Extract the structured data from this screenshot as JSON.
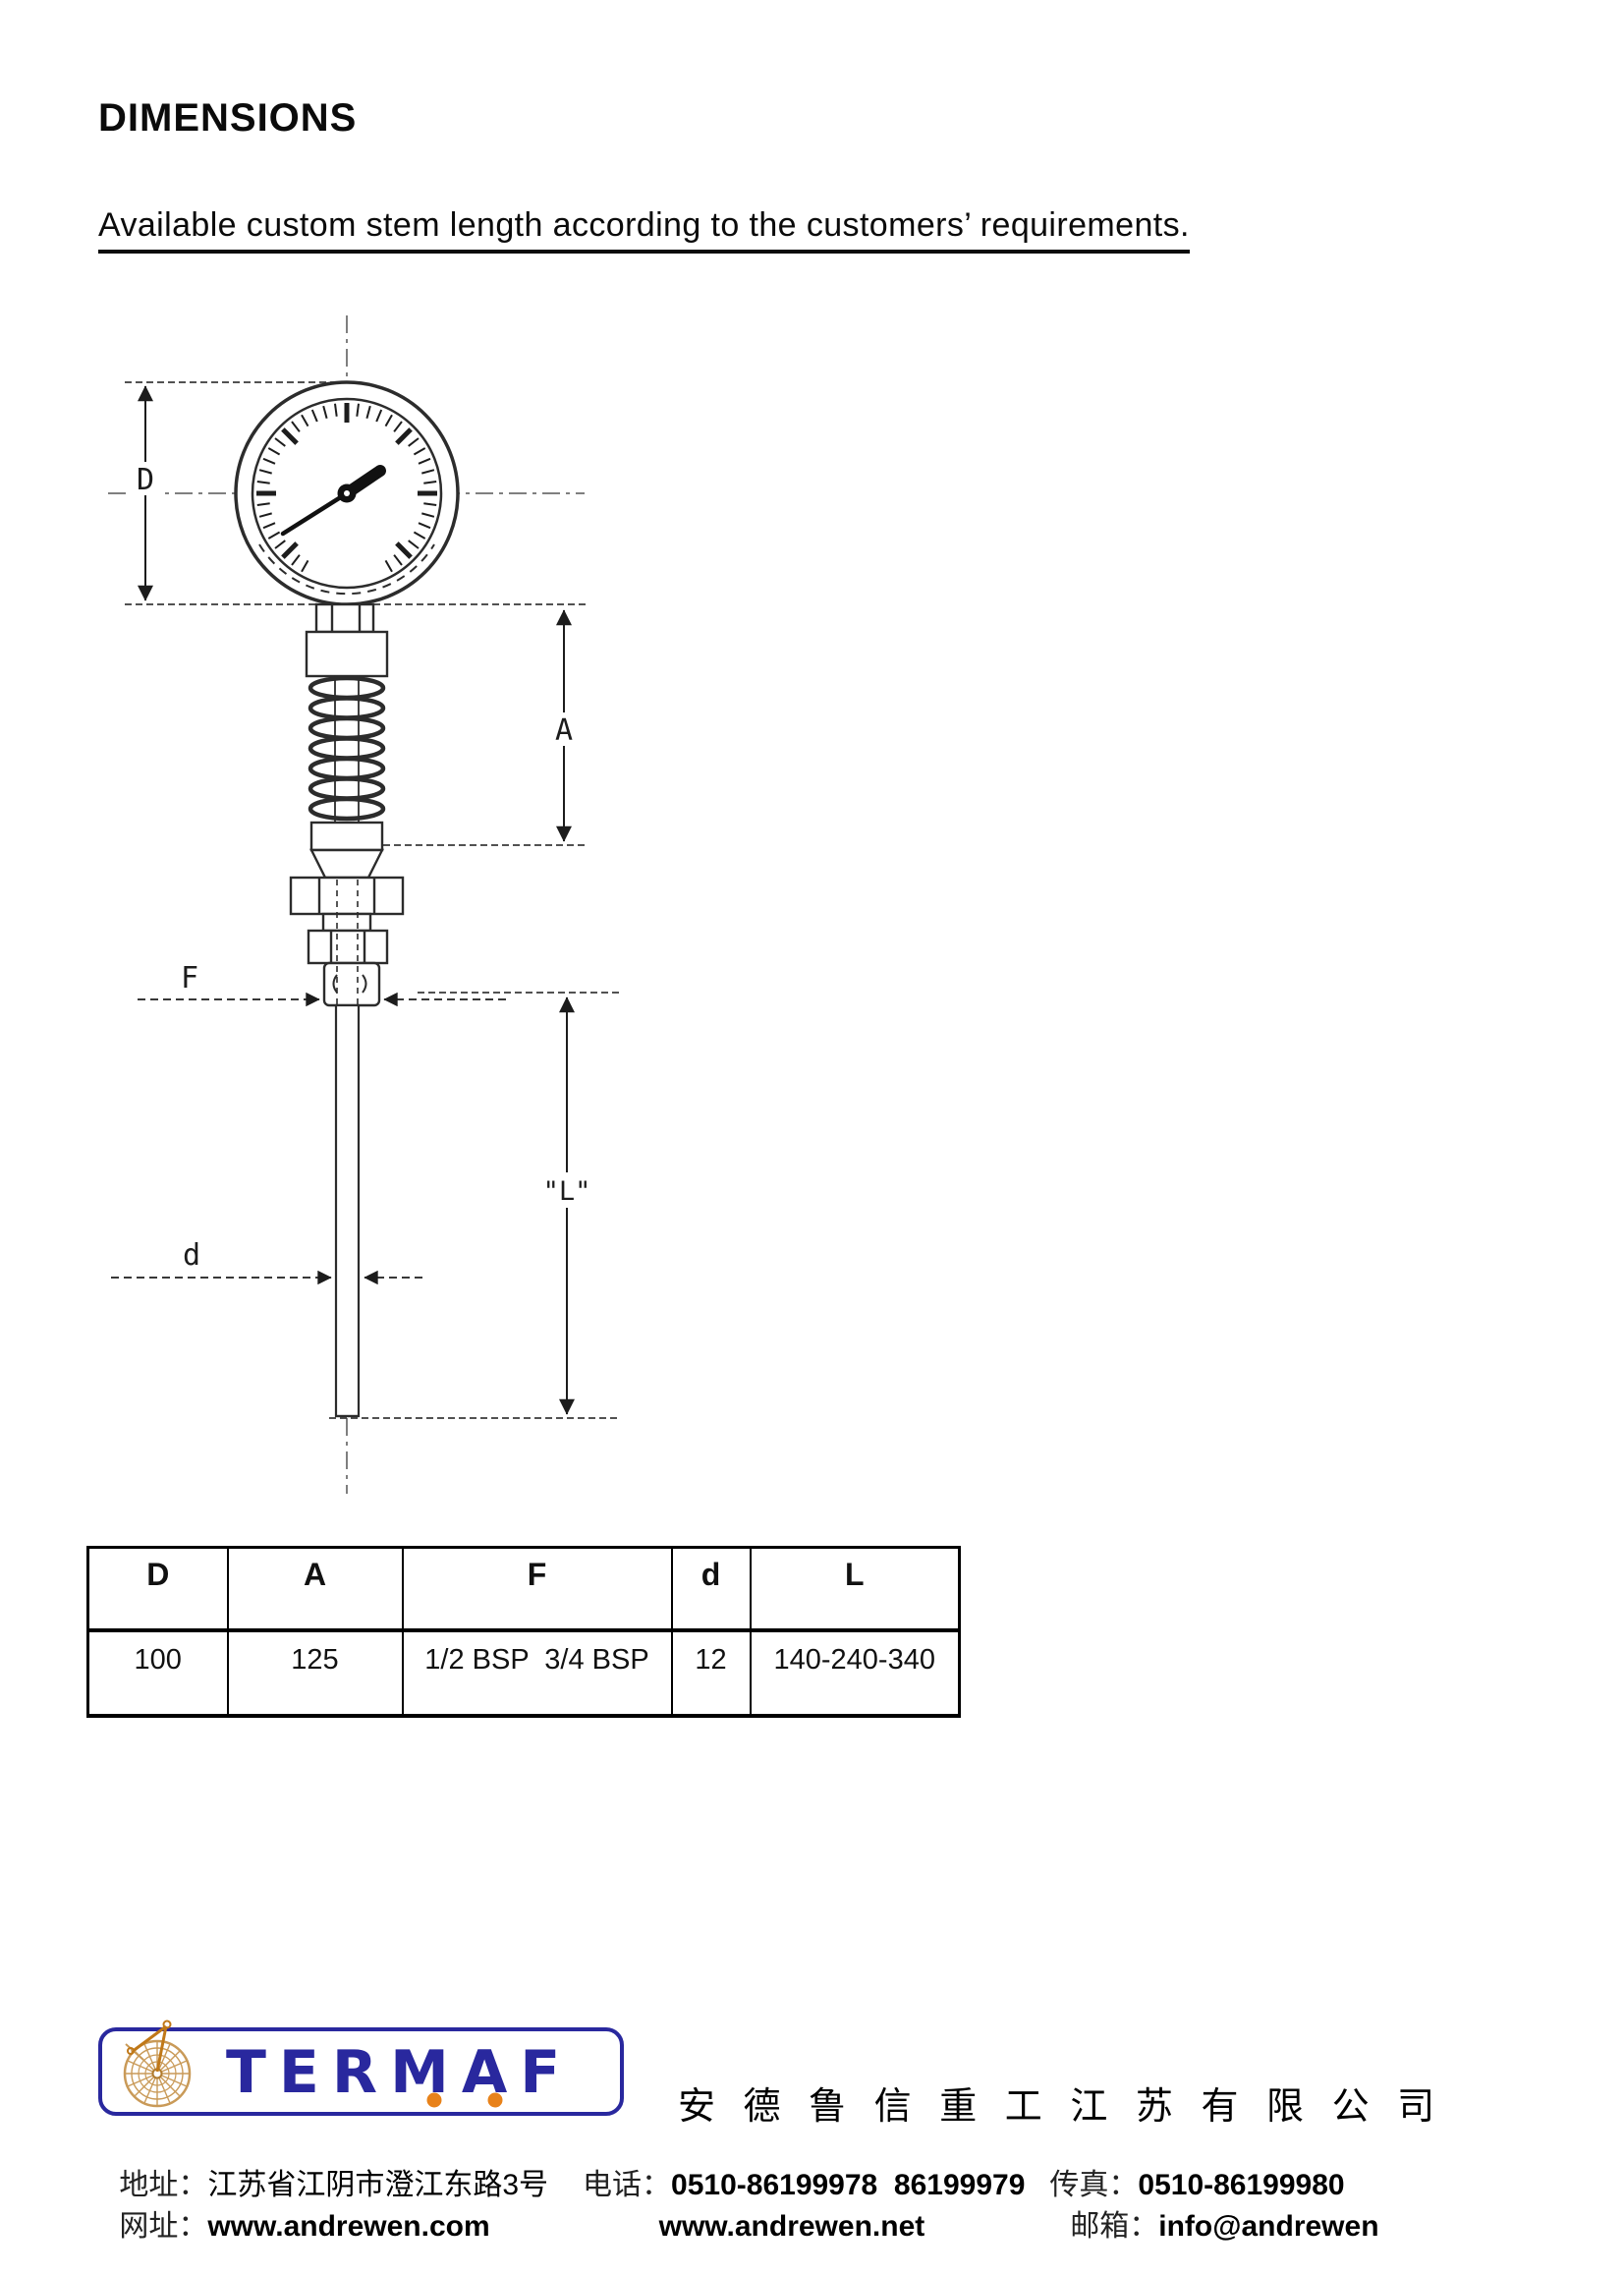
{
  "page": {
    "title": "DIMENSIONS",
    "subtitle": "Available custom stem length according to the customers’ requirements."
  },
  "drawing": {
    "labels": {
      "D": "D",
      "A": "A",
      "F": "F",
      "L": "\"L\"",
      "d": "d"
    }
  },
  "table": {
    "headers": [
      "D",
      "A",
      "F",
      "d",
      "L"
    ],
    "rows": [
      [
        "100",
        "125",
        "1/2 BSP  3/4 BSP",
        "12",
        "140-240-340"
      ]
    ]
  },
  "footer": {
    "logo_text": "TERMAF",
    "company_name_cn": "安 德 鲁 信 重 工 江 苏 有 限 公 司",
    "contact": {
      "address_label": "地址：",
      "address": "江苏省江阴市澄江东路3号",
      "phone_label": "电话：",
      "phone": "0510-86199978  86199979",
      "fax_label": "传真：",
      "fax": "0510-86199980",
      "web_label": "网址：",
      "web1": "www.andrewen.com",
      "web2": "www.andrewen.net",
      "email_label": "邮箱：",
      "email": "info@andrewen"
    },
    "colors": {
      "navy": "#29289e",
      "orange": "#e8821a",
      "tan": "#c99a58"
    }
  }
}
